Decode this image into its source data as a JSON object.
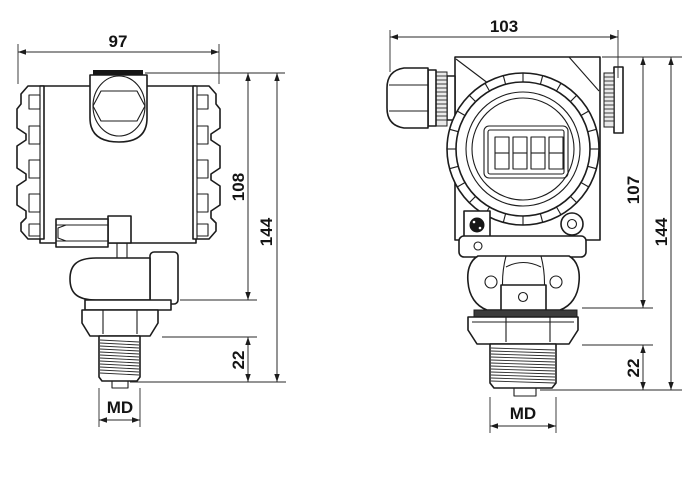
{
  "drawing": {
    "background": "#ffffff",
    "line_color": "#1c1c1c",
    "views": {
      "side": {
        "dims": {
          "width": "97",
          "body_height": "108",
          "total_height": "144",
          "thread_length": "22",
          "thread_size": "MD"
        }
      },
      "front": {
        "display_digit_cells": 4,
        "dims": {
          "width": "103",
          "body_height": "107",
          "total_height": "144",
          "thread_length": "22",
          "thread_size": "MD"
        }
      }
    }
  }
}
